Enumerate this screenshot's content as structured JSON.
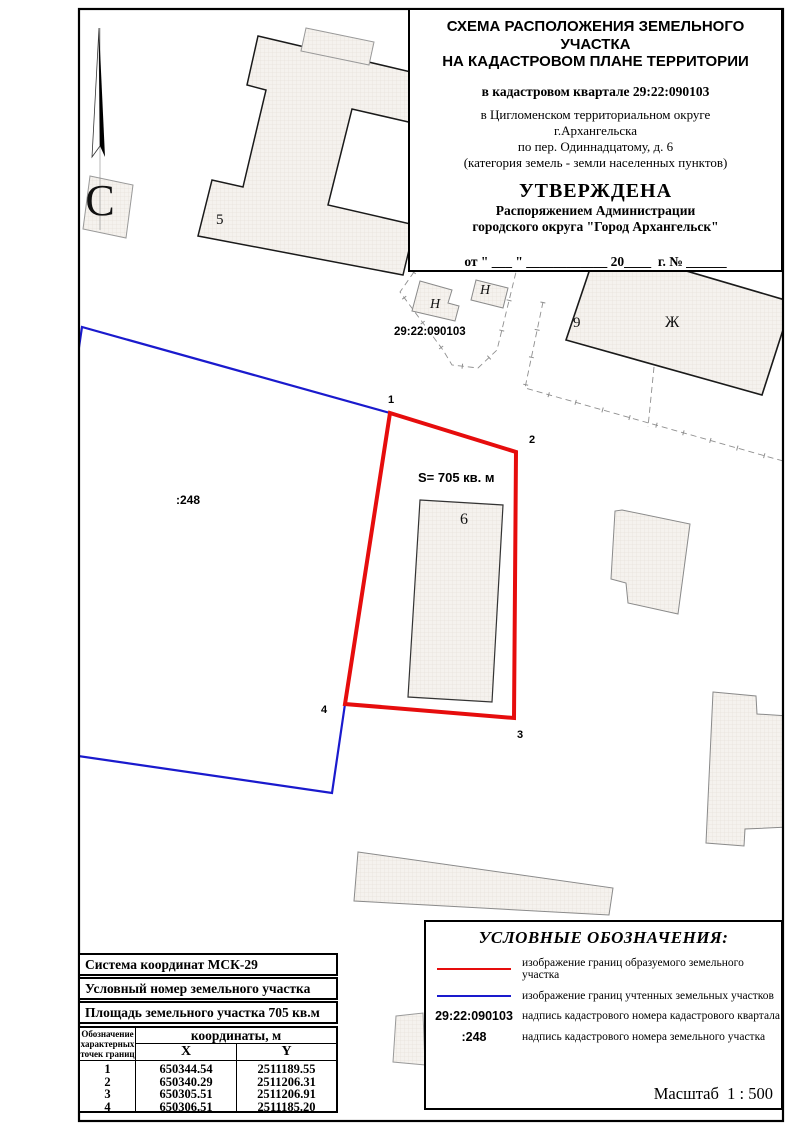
{
  "title_block": {
    "heading1": "СХЕМА РАСПОЛОЖЕНИЯ ЗЕМЕЛЬНОГО УЧАСТКА",
    "heading2": "НА КАДАСТРОВОМ ПЛАНЕ ТЕРРИТОРИИ",
    "quarter": "в кадастровом квартале 29:22:090103",
    "location1": "в Цигломенском территориальном округе",
    "location2": "г.Архангельска",
    "address": "по пер. Одиннадцатому, д. 6",
    "category": "(категория земель - земли населенных пунктов)",
    "approved": "УТВЕРЖДЕНА",
    "approved_by1": "Распоряжением Администрации",
    "approved_by2": "городского округа \"Город Архангельск\"",
    "date_line": "от \" ___ \" ____________ 20____  г. № ______"
  },
  "map": {
    "labels": {
      "north": "С",
      "parcel5": "5",
      "h_left": "Н",
      "h_right": "Н",
      "quarter_number": "29:22:090103",
      "parcel9": "9",
      "building_zh": "Ж",
      "point1": "1",
      "point2": "2",
      "point3": "3",
      "point4": "4",
      "area": "S= 705 кв. м",
      "building6": "6",
      "parcel248": ":248"
    }
  },
  "table": {
    "system_row": "Система координат МСК-29",
    "number_row": "Условный номер земельного участка",
    "area_row": "Площадь земельного участка 705 кв.м",
    "points_header1": "Обозначение",
    "points_header2": "характерных",
    "points_header3": "точек границ",
    "coords_header": "координаты, м",
    "x_header": "Х",
    "y_header": "Y",
    "rows": [
      {
        "n": "1",
        "x": "650344.54",
        "y": "2511189.55"
      },
      {
        "n": "2",
        "x": "650340.29",
        "y": "2511206.31"
      },
      {
        "n": "3",
        "x": "650305.51",
        "y": "2511206.91"
      },
      {
        "n": "4",
        "x": "650306.51",
        "y": "2511185.20"
      }
    ]
  },
  "legend": {
    "title": "УСЛОВНЫЕ ОБОЗНАЧЕНИЯ:",
    "items": [
      {
        "symbol": "red-line",
        "label": "изображение границ образуемого земельного участка"
      },
      {
        "symbol": "blue-line",
        "label": "изображение границ учтенных земельных участков"
      },
      {
        "symbol": "29:22:090103",
        "label": "надпись кадастрового номера кадастрового квартала"
      },
      {
        "symbol": ":248",
        "label": "надпись кадастрового номера земельного участка"
      }
    ],
    "scale": "Масштаб  1 : 500"
  },
  "colors": {
    "formed_parcel_boundary": "#e60d0d",
    "registered_parcel_boundary": "#1a1acd",
    "building_fill": "#f5f2ee",
    "frame": "#000000"
  }
}
